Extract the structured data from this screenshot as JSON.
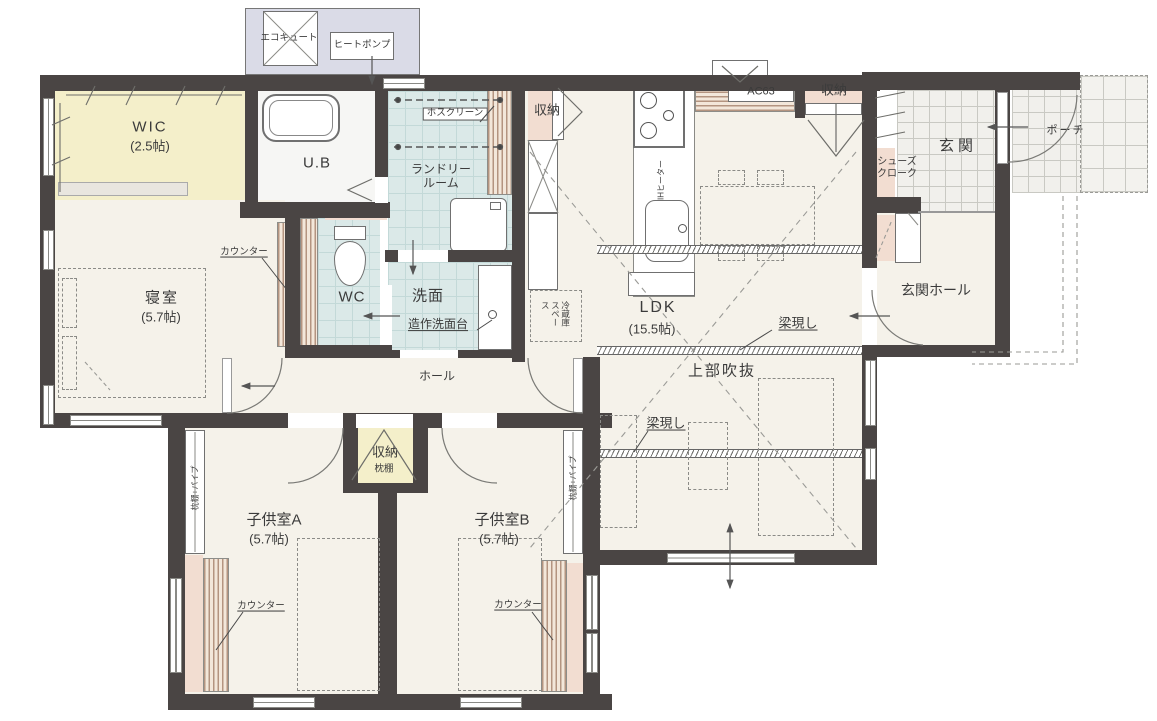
{
  "title": "1階 間取り図",
  "colors": {
    "wall": "#4a4544",
    "floor": "#f5f2ea",
    "wet_area": "#dbe9e8",
    "wic_yellow": "#f4efca",
    "closet_pink": "#f2ddd1",
    "equipment_lavender": "#dadbe7",
    "wood_counter": "#b49480",
    "porch_tile": "#f1f0ec",
    "line": "#666666"
  },
  "labels": {
    "ecocute": "エコキュート",
    "heatpump": "ヒートポンプ",
    "wic_name": "WIC",
    "wic_size": "(2.5帖)",
    "ub": "U.B",
    "hosclean": "ホスクリーン",
    "laundry": "ランドリールーム",
    "storage_kitchen": "収納",
    "ac63": "AC63",
    "storage_entry": "収納",
    "genkan": "玄関",
    "porch": "ポーチ",
    "shoes_cloak": "シューズクローク",
    "genkan_hall": "玄関ホール",
    "ldk_name": "LDK",
    "ldk_size": "(15.5帖)",
    "ih_heater": "IHヒーター",
    "fridge_space": "冷蔵庫スペース",
    "beam_1": "梁現し",
    "beam_2": "梁現し",
    "void_above": "上部吹抜",
    "counter_bedroom": "カウンター",
    "counter_child_a": "カウンター",
    "counter_child_b": "カウンター",
    "bedroom_name": "寝室",
    "bedroom_size": "(5.7帖)",
    "wc": "WC",
    "senmen": "洗面",
    "vanity": "造作洗面台",
    "hall": "ホール",
    "storage_hall": "収納",
    "makura_shelf": "枕棚",
    "child_a_name": "子供室A",
    "child_a_size": "(5.7帖)",
    "child_b_name": "子供室B",
    "child_b_size": "(5.7帖)",
    "pipe_shelf_a": "枕棚+パイプ",
    "pipe_shelf_b": "枕棚+パイプ"
  }
}
